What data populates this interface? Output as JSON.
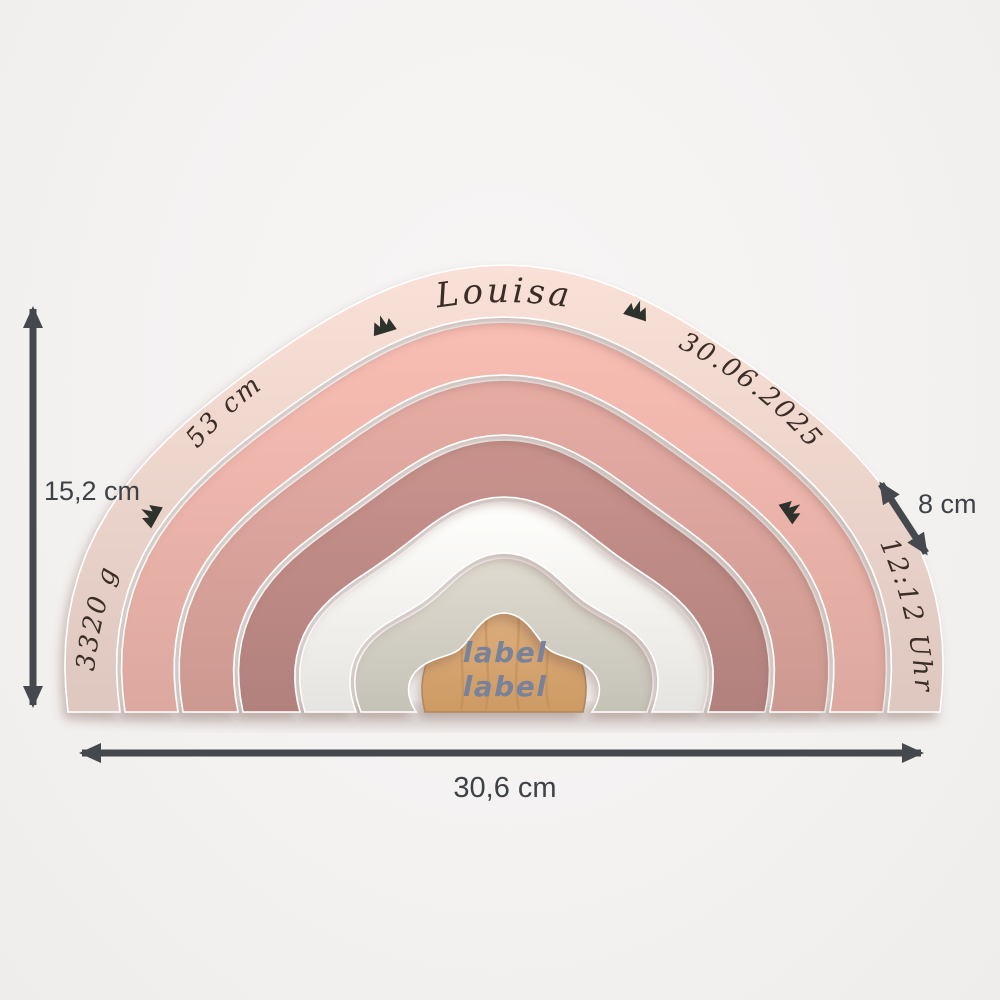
{
  "product": {
    "type": "wooden-rainbow-stacking-toy",
    "brand_logo": {
      "line1": "label",
      "line2": "label",
      "color": "#78829b"
    },
    "pieces": [
      {
        "name": "arch-1-blush",
        "color": "#eed6cd"
      },
      {
        "name": "arch-2-salmon",
        "color": "#edb5ab"
      },
      {
        "name": "arch-3-dusty-rose",
        "color": "#dba49c"
      },
      {
        "name": "arch-4-mauve",
        "color": "#bf8b86"
      },
      {
        "name": "arch-5-white",
        "color": "#f7f5f1"
      },
      {
        "name": "arch-6-greige",
        "color": "#d4d1c6"
      },
      {
        "name": "cloud-center-wood",
        "color": "#d7a672",
        "grain_color": "#bf8c56"
      }
    ],
    "engravings": {
      "name": "Louisa",
      "height": "53 cm",
      "birth_date": "30.06.2025",
      "weight": "3320 g",
      "time": "12:12 Uhr",
      "color": "#3a2d26",
      "crown_icon_count": 4,
      "crown_color": "#2e322c"
    }
  },
  "dimensions": {
    "height": {
      "label": "15,2 cm"
    },
    "width": {
      "label": "30,6 cm"
    },
    "depth": {
      "label": "8 cm"
    },
    "arrow_color": "#45484c",
    "label_color": "#3e4247"
  }
}
